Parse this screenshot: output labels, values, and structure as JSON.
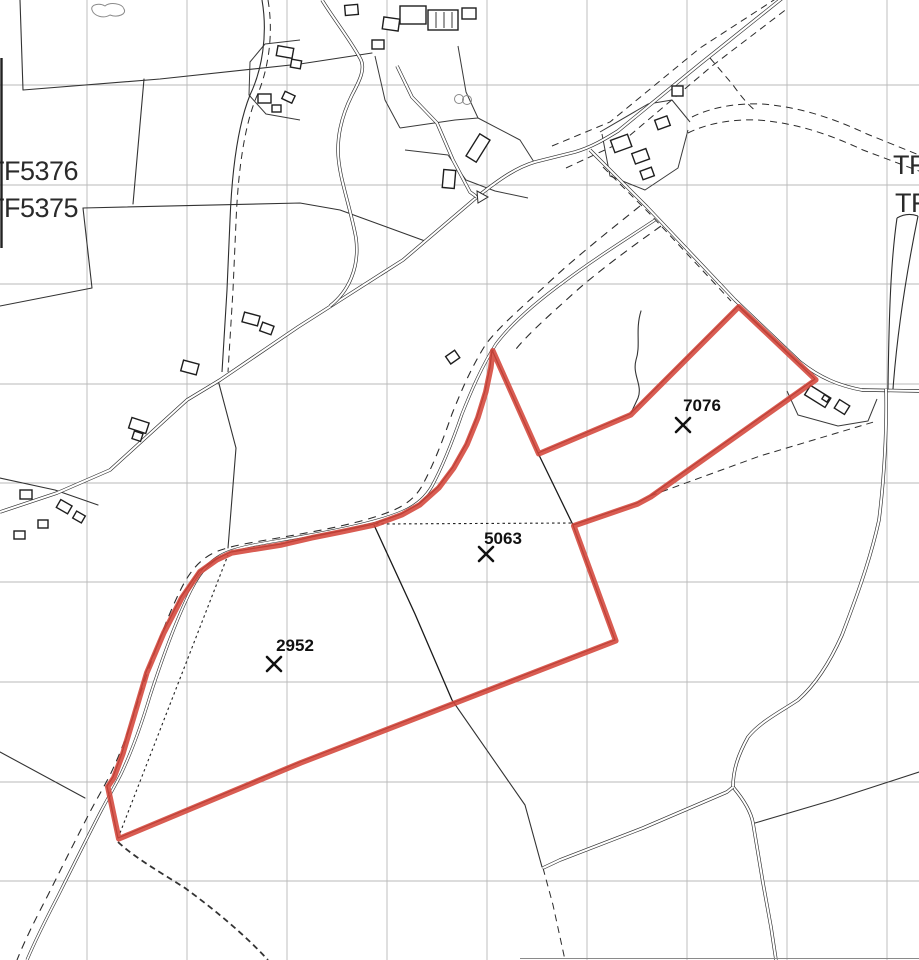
{
  "map": {
    "kind": "land-registry-field-plan",
    "grid_labels": {
      "left_top": "TF5376",
      "left_bottom": "TF5375",
      "right_top": "TF",
      "right_bottom": "TF"
    },
    "parcels": [
      {
        "number": "7076",
        "marker": "X"
      },
      {
        "number": "5063",
        "marker": "X"
      },
      {
        "number": "2952",
        "marker": "X"
      }
    ],
    "colors": {
      "parcel_boundary": "#d4453a",
      "map_lines": "#2d2d2d",
      "grid": "#b9b9b9",
      "background": "#ffffff"
    }
  }
}
